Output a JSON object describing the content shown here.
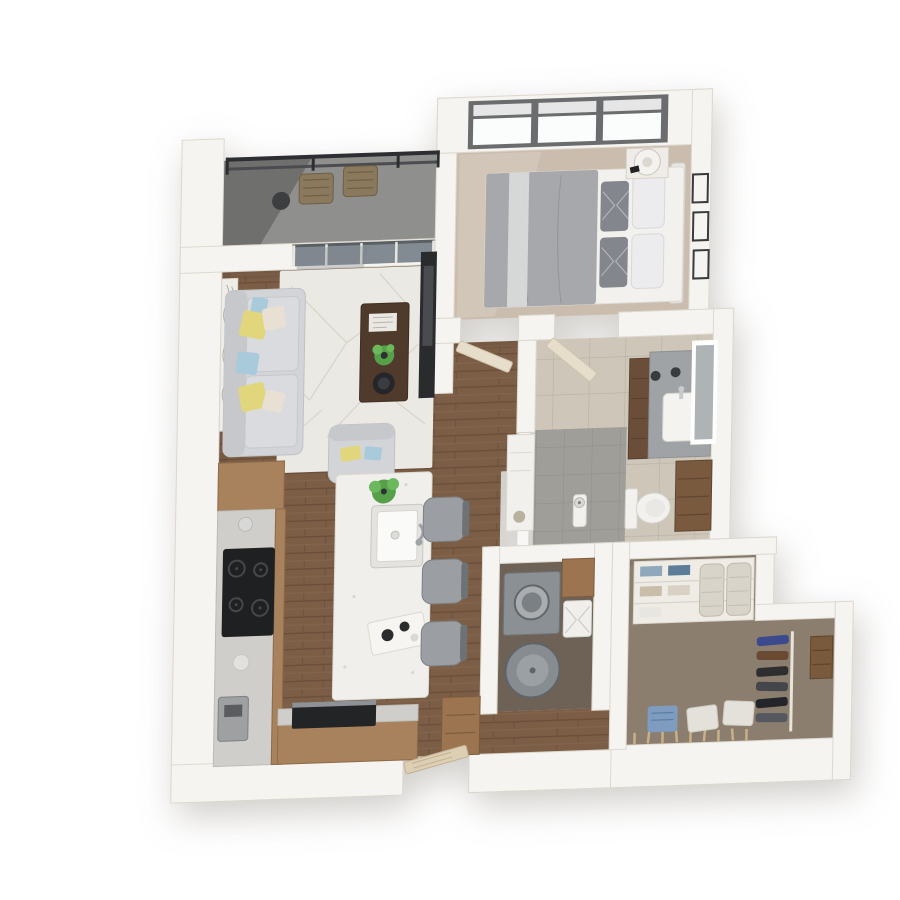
{
  "image": {
    "kind": "3d-floorplan-render",
    "description": "Top-down 3D rendering of a one-bedroom, one-bathroom apartment floor plan with balcony and walk-in closet",
    "background": "#ffffff",
    "text_visible": ""
  },
  "colors": {
    "wall": "#f6f4f0",
    "wall_edge": "#ddd8ce",
    "wood": "#7c5e46",
    "carpet_bedroom": "#cabdad",
    "carpet_closet": "#8b7e6f",
    "laundry_floor": "#6e6257",
    "balcony_floor": "#8f8f8d",
    "railing": "#2c2e31",
    "rug": "#ebe9e3",
    "sofa": "#d3d4d7",
    "pillow_yellow": "#e2d67d",
    "pillow_blue": "#a9cadb",
    "pillow_beige": "#e8e1d3",
    "table_walnut": "#4f3a2c",
    "plant": "#57a04a",
    "tv": "#2a2b2d",
    "counter_wood": "#a8825d",
    "countertop": "#cfcecb",
    "island": "#f0efeb",
    "stove": "#1f2022",
    "appliance_gray": "#8b9094",
    "fixture_white": "#f2f1ee",
    "vanity_wood": "#6b4e39",
    "vanity_counter": "#9fa3a6",
    "tile_bath": "#cdc6b9",
    "tile_shower": "#a09e98",
    "door_wood": "#e7ddcb",
    "entry_door": "#ddcfb4",
    "window_frame": "#6a6c6e",
    "window_glass": "#fbfcfc",
    "glass_reflect": "#78818a",
    "basket": "#d9d4ca",
    "bin_blue": "#7d9cc0",
    "closet_wood": "#7a5a3c",
    "frame_dark": "#3a3b3d"
  },
  "rooms": [
    {
      "name": "balcony",
      "items": [
        "metal-railing",
        "lounge-chairs",
        "side-table"
      ]
    },
    {
      "name": "living-room",
      "items": [
        "sofa",
        "accent-pillows",
        "area-rug",
        "coffee-table",
        "magazine",
        "potted-plant",
        "armchair",
        "wall-tv",
        "curtain-panel",
        "sliding-glass-door"
      ]
    },
    {
      "name": "bedroom",
      "items": [
        "double-bed",
        "pillows",
        "nightstand",
        "table-lamp",
        "picture-frames",
        "triple-window"
      ]
    },
    {
      "name": "kitchen",
      "items": [
        "l-shaped-counter",
        "cooktop",
        "black-appliance",
        "coffee-machine",
        "island",
        "sink",
        "bar-stools",
        "plant"
      ]
    },
    {
      "name": "hallway",
      "items": [
        "bedroom-door",
        "bathroom-door",
        "pantry-cabinet"
      ]
    },
    {
      "name": "bathroom",
      "items": [
        "vanity",
        "sink",
        "lit-mirror",
        "sconces",
        "toilet",
        "linen-cabinet",
        "walk-in-shower",
        "glass-partition"
      ]
    },
    {
      "name": "laundry-closet",
      "items": [
        "washer",
        "dryer",
        "laundry-hamper",
        "wood-cabinet"
      ]
    },
    {
      "name": "walk-in-closet",
      "items": [
        "shelving-unit",
        "folded-clothes",
        "storage-baskets",
        "hanging-clothes",
        "shoe-pegs",
        "storage-boxes",
        "blue-bin"
      ]
    },
    {
      "name": "entry",
      "items": [
        "entry-door",
        "console-cabinet"
      ]
    }
  ]
}
